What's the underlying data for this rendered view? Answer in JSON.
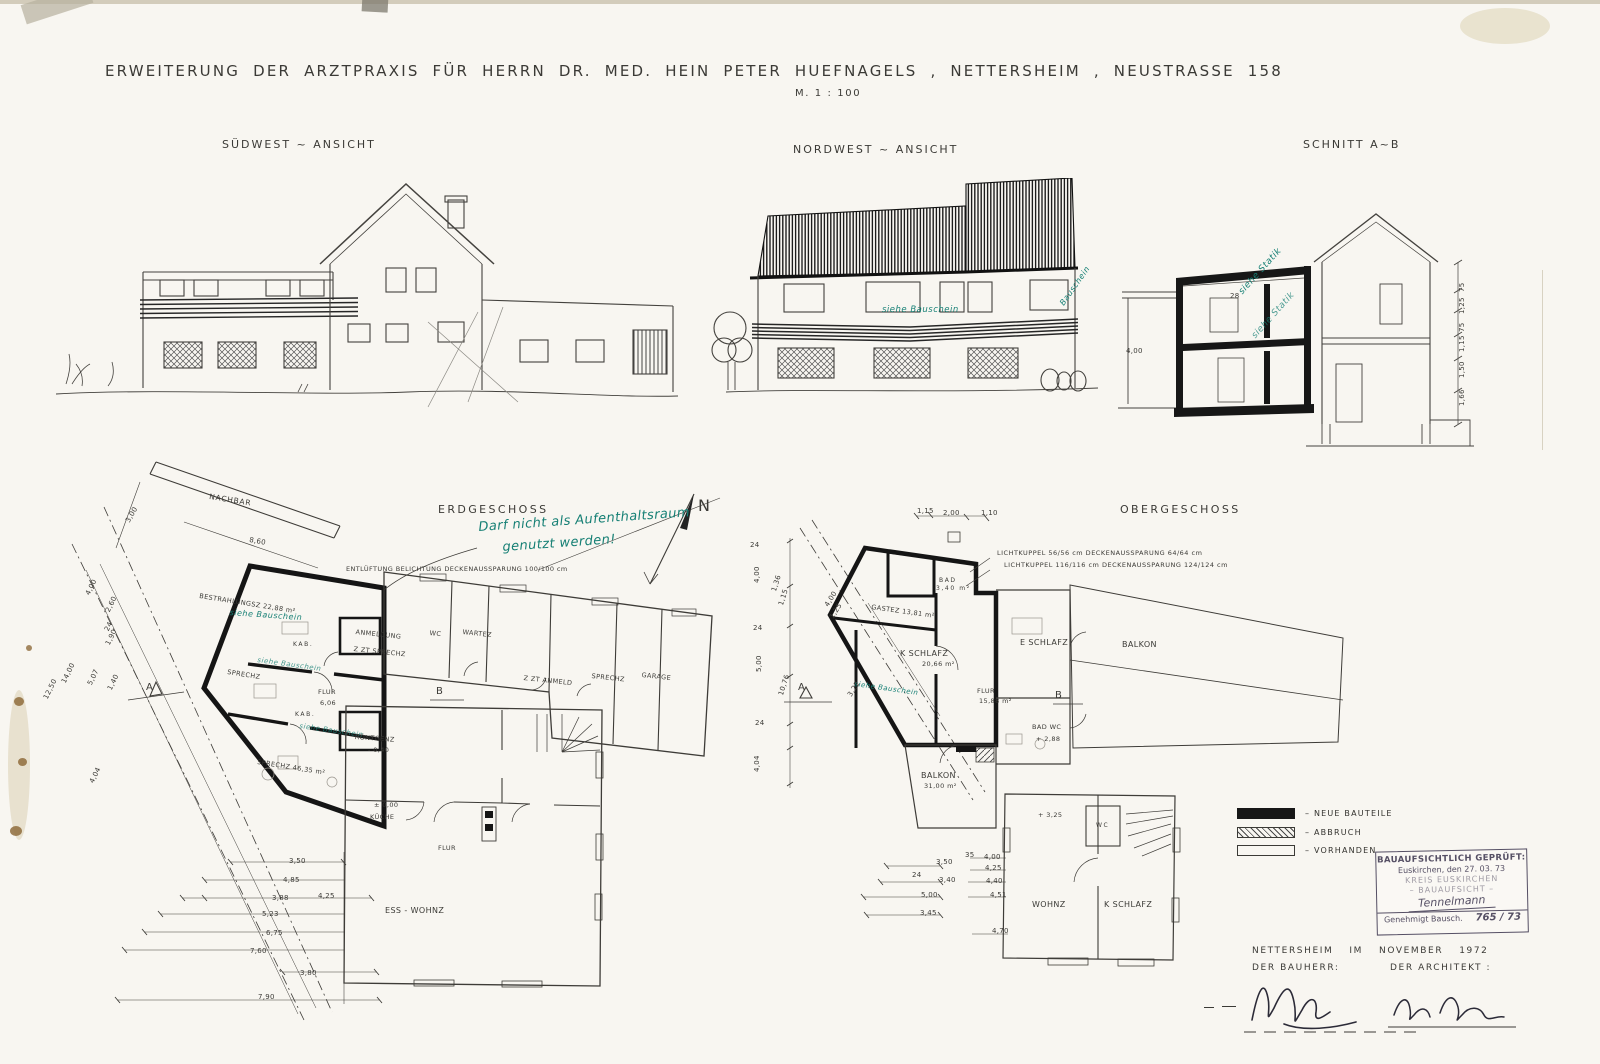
{
  "colors": {
    "paper": "#f8f6f1",
    "ink": "#3b3a36",
    "teal": "#157f74",
    "stamp_ink": "#554f64",
    "stain": "#8f6c3c"
  },
  "title": {
    "text": "ERWEITERUNG DER ARZTPRAXIS FÜR HERRN DR. MED. HEIN PETER HUEFNAGELS , NETTERSHEIM , NEUSTRASSE 158",
    "scale": "M. 1 : 100"
  },
  "views": {
    "suedwest": "SÜDWEST ~ ANSICHT",
    "nordwest": "NORDWEST ~ ANSICHT",
    "schnitt": "SCHNITT A~B"
  },
  "notes": {
    "no_stay_line1": "Darf nicht als Aufenthaltsraum",
    "no_stay_line2": "genutzt werden!",
    "siehe_bauschein": "siehe Bauschein",
    "bauschein": "Bauschein",
    "siehe_statik": "siehe Statik",
    "north": "N"
  },
  "eg": {
    "title": "ERDGESCHOSS",
    "nachbar": "NACHBAR",
    "entlueftung": "ENTLÜFTUNG  BELICHTUNG  DECKENAUSSPARUNG  100/100 cm",
    "rooms": {
      "bestrahlungsz": "BESTRAHLUNGSZ  22,88 m²",
      "sprechz1": "SPRECHZ",
      "kab1": "KAB.",
      "kab2": "KAB.",
      "sprechz2": "SPRECHZ  46,35 m²",
      "anmeldung1": "ANMELDUNG",
      "anmeldung2": "Z ZT SPRECHZ",
      "wc": "WC",
      "wartez": "WARTEZ",
      "flur1": "FLUR",
      "flur1_wert": "6,06",
      "roentgenz": "RÖNTGENZ",
      "roentgenz_wert": "- 0,40",
      "zzt_anmeld": "Z ZT ANMELD",
      "sprechz3": "SPRECHZ",
      "garage": "GARAGE",
      "kueche_niveau": "± 0,00",
      "kueche": "KÜCHE",
      "flur2": "FLUR",
      "ess_wohnz": "ESS - WOHNZ"
    },
    "marker_a": "A",
    "marker_b": "B",
    "dims_links": [
      "3,50",
      "4,85",
      "3,88",
      "4,25",
      "5,23",
      "6,75",
      "7,60",
      "3,80",
      "7,90"
    ],
    "dims_diagonal": [
      "2,60",
      "24",
      "1,90",
      "1,40",
      "4,00",
      "5,07",
      "14,00",
      "12,50",
      "4,04"
    ],
    "dims_nachbar": [
      "8,60",
      "3,00"
    ]
  },
  "og": {
    "title": "OBERGESCHOSS",
    "lichtkuppel1": "LICHTKUPPEL  56/56 cm   DECKENAUSSPARUNG  64/64 cm",
    "lichtkuppel2": "LICHTKUPPEL  116/116 cm   DECKENAUSSPARUNG  124/124 cm",
    "rooms": {
      "bad": "BAD",
      "bad_wert": "3,40 m²",
      "gastez": "GASTEZ  13,81 m²",
      "k_schlafz": "K SCHLAFZ",
      "k_schlafz_wert": "20,66 m²",
      "flur": "FLUR",
      "flur_wert": "15,88 m²",
      "e_schlafz": "E SCHLAFZ",
      "balkon_og": "BALKON",
      "bad_wc": "BAD  WC",
      "bad_wc_wert": "+ 2,88",
      "balkon_neu": "BALKON",
      "balkon_neu_wert": "31,00 m²",
      "niveau": "+ 3,25",
      "wc": "WC",
      "wohnz": "WOHNZ",
      "k_schlafz2": "K SCHLAFZ"
    },
    "marker_a": "A",
    "marker_b": "B",
    "dims_links": [
      "24",
      "4,00",
      "1,36",
      "1,15",
      "24",
      "5,00",
      "10,76",
      "24",
      "4,04"
    ],
    "dims_diagonal": [
      "4,00",
      "1,25",
      "3,22"
    ],
    "dims_unten_a": [
      "3,50",
      "3,40",
      "5,00",
      "3,45",
      "24"
    ],
    "dims_unten_b": [
      "35",
      "4,00",
      "4,25",
      "4,40",
      "4,51",
      "4,70"
    ],
    "dims_oben": [
      "1,15",
      "2,00",
      "1,10"
    ]
  },
  "schnitt": {
    "dims_rechts": [
      "75",
      "1,25",
      "75",
      "1,15",
      "1,50",
      "1,66"
    ],
    "dim_decke": "28",
    "dim_links": "4,00"
  },
  "legend": {
    "neue_bauteile": "–  NEUE  BAUTEILE",
    "abbruch": "–  ABBRUCH",
    "vorhanden": "–  VORHANDEN"
  },
  "stamp": {
    "zeile1": "BAUAUFSICHTLICH GEPRÜFT:",
    "zeile2": "Euskirchen, den  27. 03. 73",
    "zeile3": "KREIS EUSKIRCHEN",
    "zeile4": "– BAUAUFSICHT –",
    "unterschrift": "Tennelmann",
    "zeile5": "Genehmigt  Bausch.",
    "nummer": "765 / 73"
  },
  "footer": {
    "ort": "NETTERSHEIM",
    "im": "IM",
    "monat": "NOVEMBER",
    "jahr": "1972",
    "bauherr": "DER BAUHERR:",
    "architekt": "DER ARCHITEKT :"
  }
}
